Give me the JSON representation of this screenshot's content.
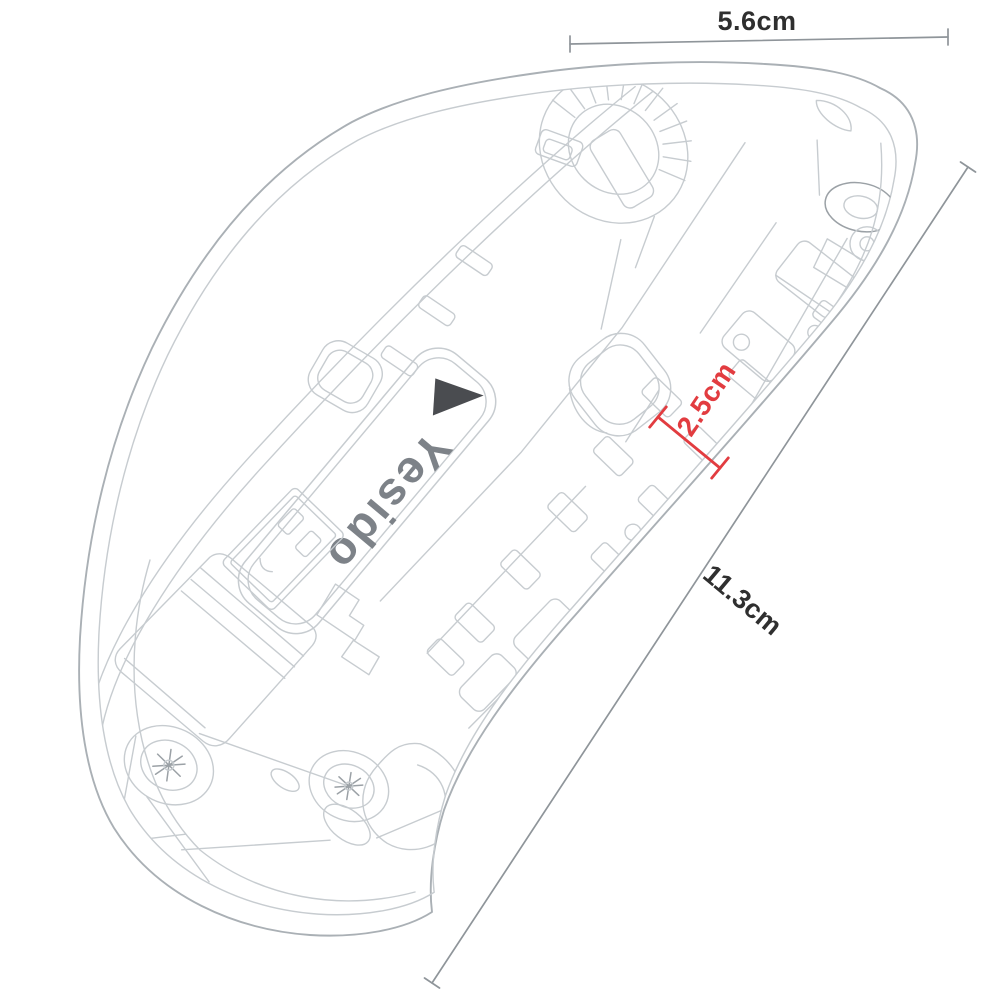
{
  "figure": {
    "subject": "wireless mouse internal bottom-view line drawing",
    "brand_label": "Yesido"
  },
  "dimensions": {
    "width": "5.6cm",
    "length": "11.3cm",
    "height": "2.5cm"
  },
  "colors": {
    "background": "#ffffff",
    "sketch_line": "#c7ccd0",
    "sketch_line_dark": "#aab0b5",
    "sketch_line_darker": "#9ba1a6",
    "dimension_line": "#8f959a",
    "dimension_text": "#2f2f2f",
    "accent_red": "#e23c40",
    "logo_mark": "#4a4c50",
    "logo_text": "#7d8288"
  }
}
